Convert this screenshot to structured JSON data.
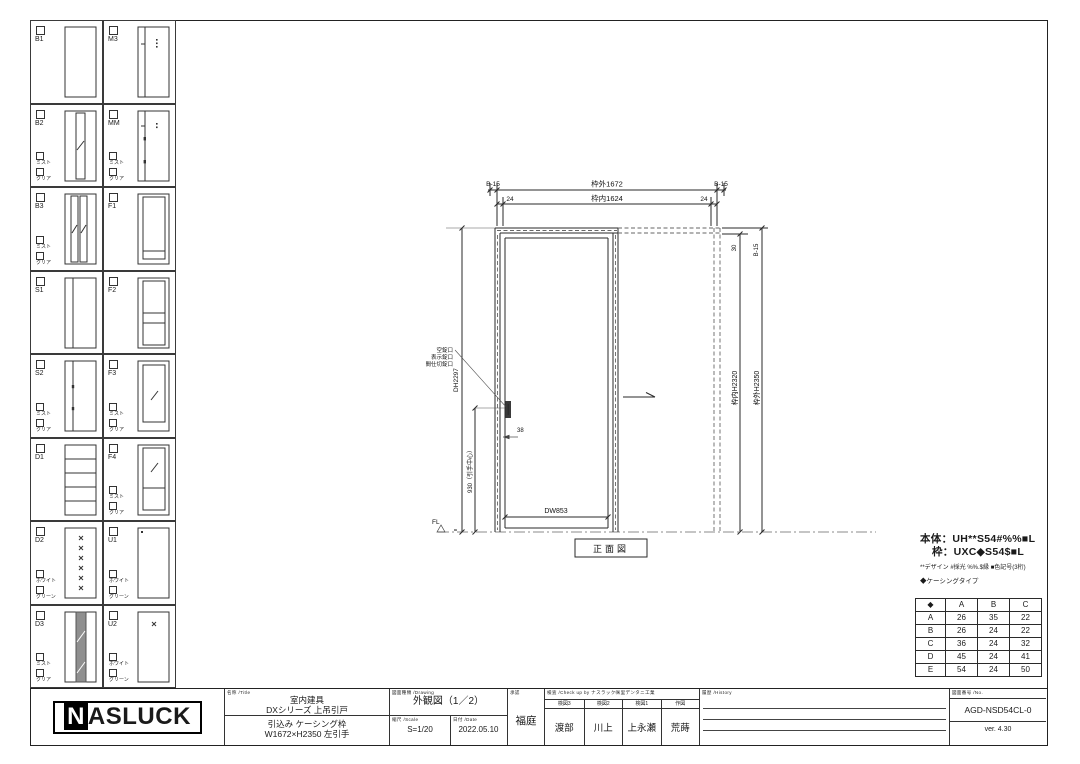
{
  "sidebar": {
    "cells": [
      {
        "code": "B1",
        "options": []
      },
      {
        "code": "M3",
        "options": []
      },
      {
        "code": "B2",
        "options": [
          "ミスト",
          "クリア"
        ]
      },
      {
        "code": "MM",
        "options": [
          "ミスト",
          "クリア"
        ]
      },
      {
        "code": "B3",
        "options": [
          "ミスト",
          "クリア"
        ]
      },
      {
        "code": "F1",
        "options": []
      },
      {
        "code": "S1",
        "options": []
      },
      {
        "code": "F2",
        "options": []
      },
      {
        "code": "S2",
        "options": [
          "ミスト",
          "クリア"
        ]
      },
      {
        "code": "F3",
        "options": [
          "ミスト",
          "クリア"
        ]
      },
      {
        "code": "D1",
        "options": []
      },
      {
        "code": "F4",
        "options": [
          "ミスト",
          "クリア"
        ]
      },
      {
        "code": "D2",
        "options": [
          "ホワイト",
          "グリーン"
        ]
      },
      {
        "code": "U1",
        "options": [
          "ホワイト",
          "グリーン"
        ]
      },
      {
        "code": "D3",
        "options": [
          "ミスト",
          "クリア"
        ]
      },
      {
        "code": "U2",
        "options": [
          "ホワイト",
          "グリーン"
        ]
      }
    ]
  },
  "drawing": {
    "dim_b15_left": "B-15",
    "dim_outer_w": "枠外1672",
    "dim_b15_right": "B-15",
    "dim_24_left": "24",
    "dim_inner_w": "枠内1624",
    "dim_24_right": "24",
    "dim_30": "30",
    "dim_b15_top_right": "B-15",
    "dim_inner_h": "枠内H2320",
    "dim_outer_h": "枠外H2350",
    "dim_dh": "DH2297",
    "dim_handle_center": "930（引手中心）",
    "lock_labels": [
      "空錠口",
      "表示錠口",
      "間仕切錠口"
    ],
    "dim_38": "38",
    "dim_dw": "DW853",
    "fl_label": "FL",
    "floor_gap": "8",
    "view_label": "正面図"
  },
  "spec": {
    "body_line": "本体：UH**S54#%%■L",
    "frame_line": "枠：UXC◆S54$■L",
    "note_line": "**デザイン #採光 %%.$縁 ■色記号(3桁)",
    "casing_line": "◆ケーシングタイプ"
  },
  "table": {
    "headers": [
      "◆",
      "A",
      "B",
      "C"
    ],
    "rows": [
      [
        "A",
        "26",
        "35",
        "22"
      ],
      [
        "B",
        "26",
        "24",
        "22"
      ],
      [
        "C",
        "36",
        "24",
        "32"
      ],
      [
        "D",
        "45",
        "24",
        "41"
      ],
      [
        "E",
        "54",
        "24",
        "50"
      ]
    ]
  },
  "titleblock": {
    "logo_n": "N",
    "logo_rest": "ASLUCK",
    "name_header": "名称 /Title",
    "name_line1": "室内建具",
    "name_line2": "DXシリーズ 上吊引戸",
    "name_line3": "引込み ケーシング枠",
    "name_line4": "W1672×H2350 左引手",
    "drawing_header": "図面種類 /Drawing",
    "drawing_title": "外観図（1／2）",
    "scale_header": "縮尺 /Scale",
    "scale_value": "S=1/20",
    "date_header": "日付 /Date",
    "date_value": "2022.05.10",
    "approval_header": "承認",
    "approver": "福庭",
    "check_header": "検査 /Check up by ナスラック㈱里デンタニ工業",
    "check_cols": [
      {
        "role": "検図3",
        "name": "渡部"
      },
      {
        "role": "検図2",
        "name": "川上"
      },
      {
        "role": "検図1",
        "name": "上永瀬"
      },
      {
        "role": "作図",
        "name": "荒蒔"
      }
    ],
    "history_header": "履歴 /History",
    "no_header": "図面番号 /No.",
    "drawing_no": "AGD-NSD54CL-0",
    "version": "ver. 4.30"
  }
}
